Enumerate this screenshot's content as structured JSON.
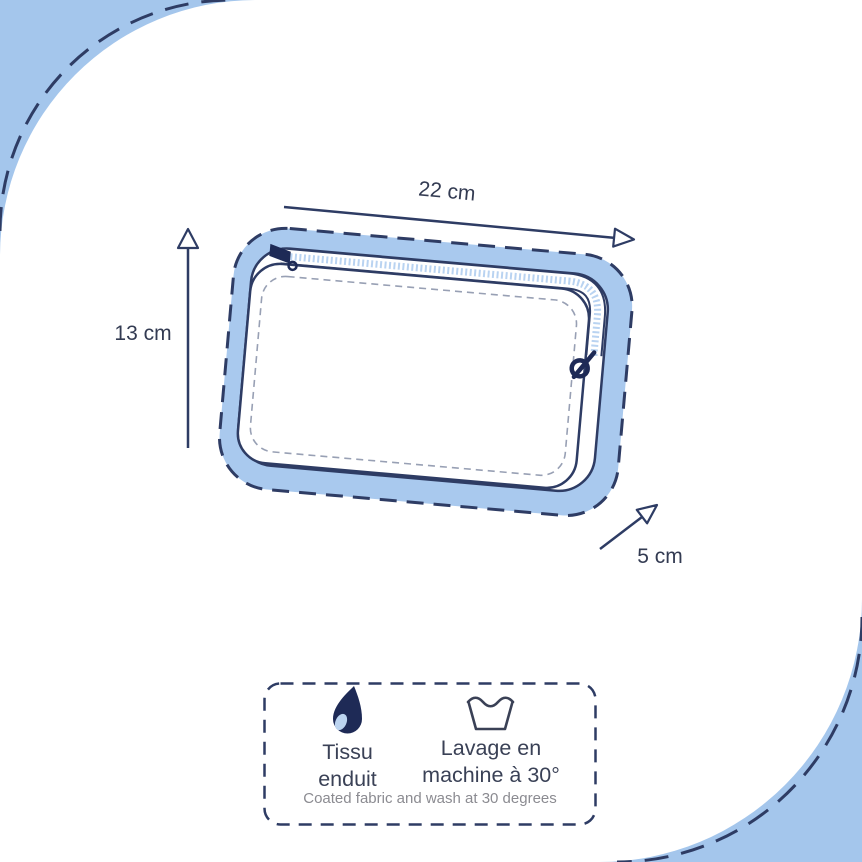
{
  "page": {
    "title": "Pouch dimensions and care diagram"
  },
  "colors": {
    "background_blue": "#a4c6ec",
    "band_blue": "#a9c9ee",
    "zipper_teeth_blue": "#b9d3f1",
    "outline_navy": "#2e3c64",
    "dark_navy": "#1e2a56",
    "label_dark": "#333b52",
    "stitch_gray": "#98a0b4",
    "footnote_gray": "#8b8b91",
    "white": "#ffffff"
  },
  "dimensions": {
    "width": {
      "label": "22 cm"
    },
    "height": {
      "label": "13 cm"
    },
    "depth": {
      "label": "5 cm"
    }
  },
  "care": {
    "fabric": {
      "icon": "water-drop-icon",
      "line1": "Tissu",
      "line2": "enduit"
    },
    "wash": {
      "icon": "wash-basin-icon",
      "line1": "Lavage en",
      "line2": "machine à 30°"
    },
    "footnote": "Coated fabric and wash at 30 degrees"
  }
}
